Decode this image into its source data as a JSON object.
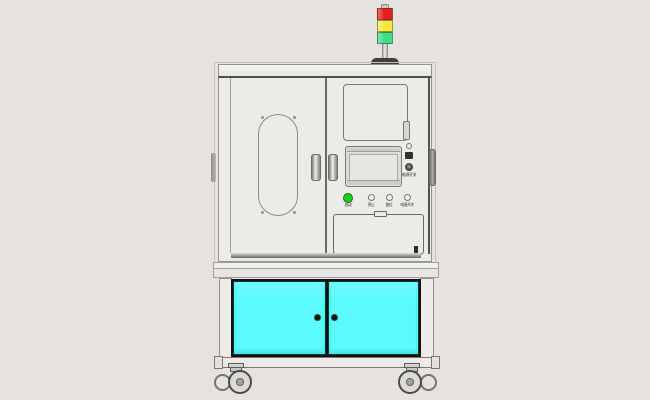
{
  "scene": {
    "name": "machine-front-view"
  },
  "colors": {
    "bg": "#e5e2df",
    "body": "#edebe8",
    "red": "#e51f1f",
    "yellow": "#f4ea3b",
    "green": "#3edc83",
    "btn_green": "#21cc21",
    "cyan": "#59fbfc",
    "cyan_border": "#063a3a"
  },
  "tower": {
    "lights": [
      "red",
      "yellow",
      "green"
    ]
  },
  "control_panel": {
    "power_label": "电源开关",
    "buttons": [
      {
        "label": "启动"
      },
      {
        "label": "停止"
      },
      {
        "label": "复位"
      },
      {
        "label": "电源开关"
      }
    ]
  }
}
